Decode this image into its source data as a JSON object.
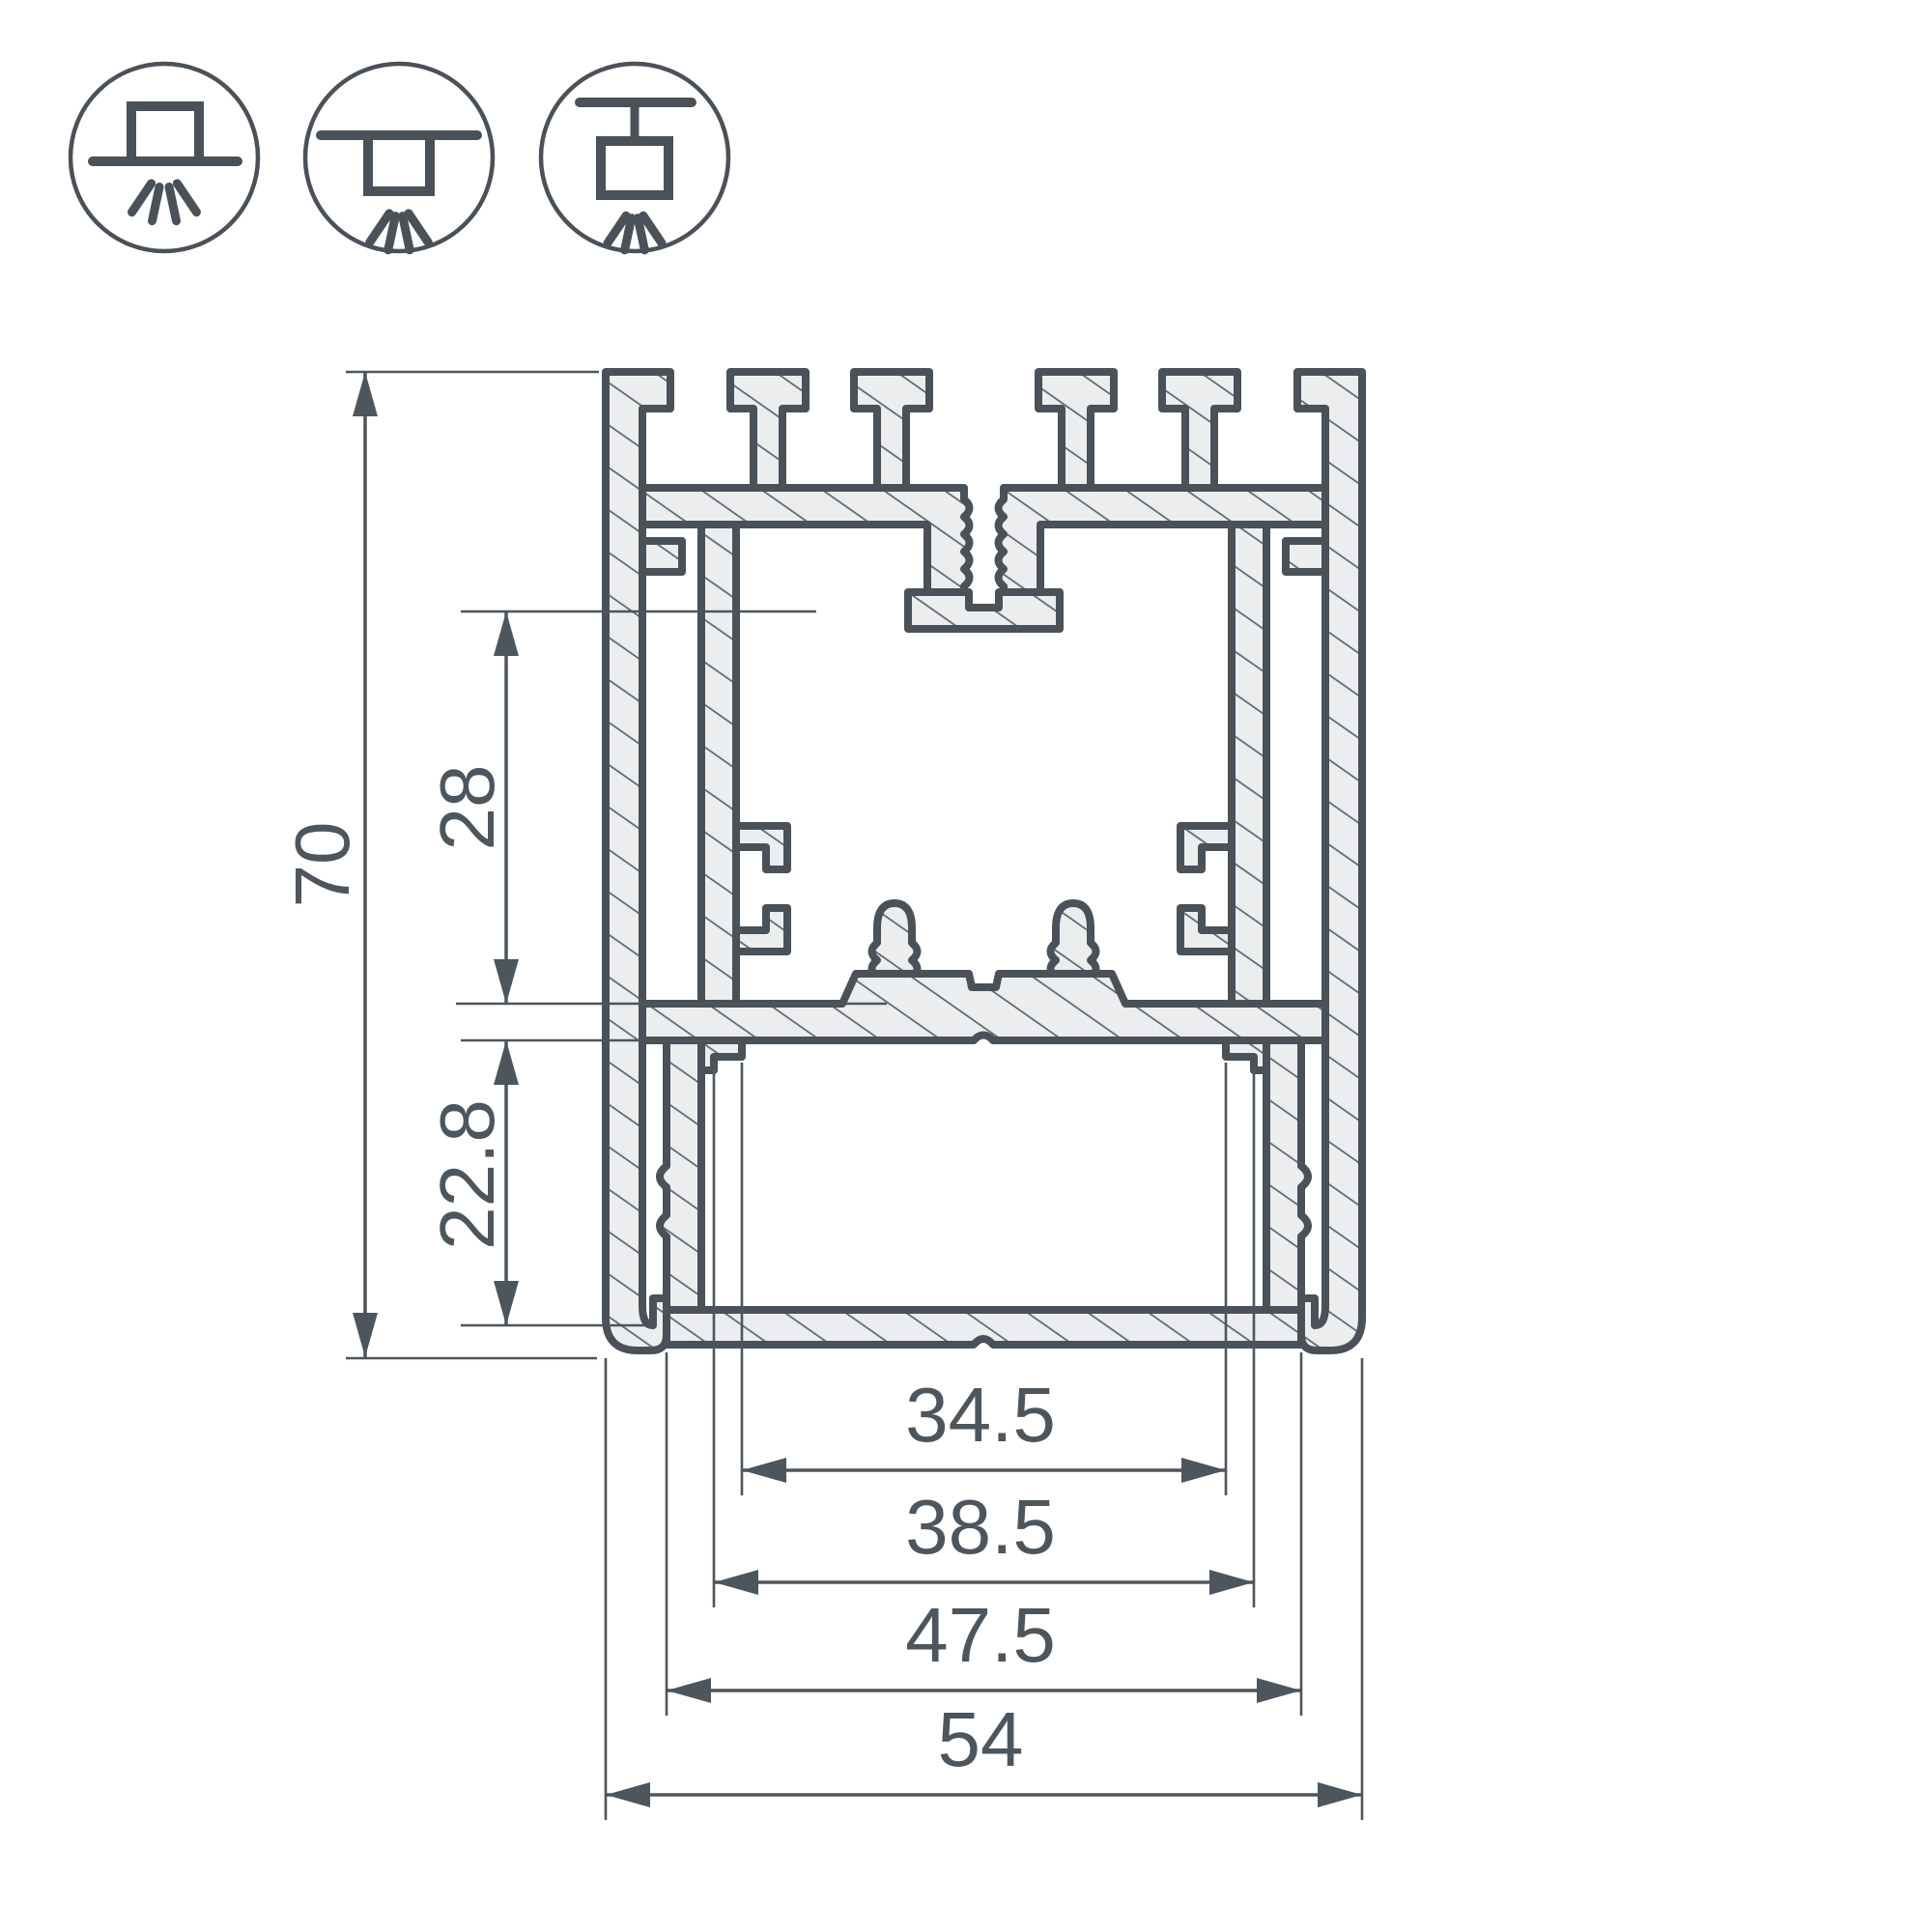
{
  "title": "Aluminium LED profile cross-section technical drawing",
  "colors": {
    "outline": "#4a5158",
    "profile_fill": "#ecedee",
    "hatch_line": "#5f6770",
    "dimension": "#4d555d",
    "background": "#ffffff"
  },
  "icons": [
    {
      "name": "surface-mount-icon"
    },
    {
      "name": "recessed-mount-icon"
    },
    {
      "name": "suspended-mount-icon"
    }
  ],
  "dimensions": {
    "vertical": [
      {
        "label": "70"
      },
      {
        "label": "28"
      },
      {
        "label": "22.8"
      }
    ],
    "horizontal": [
      {
        "label": "34.5"
      },
      {
        "label": "38.5"
      },
      {
        "label": "47.5"
      },
      {
        "label": "54"
      }
    ]
  }
}
